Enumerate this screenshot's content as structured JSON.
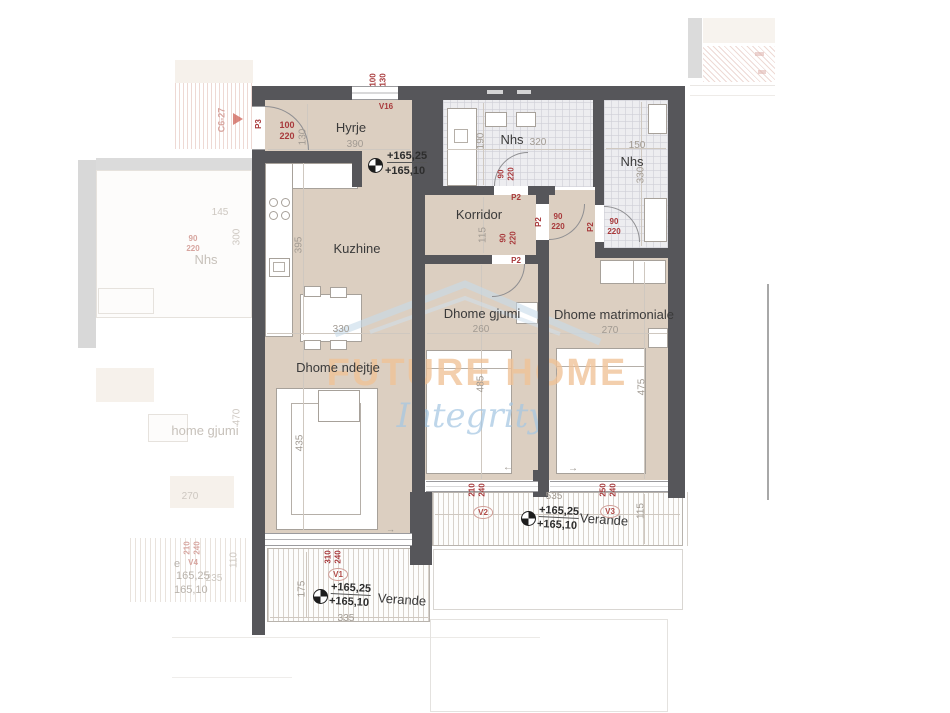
{
  "watermark": {
    "brand": "FUTURE HOME",
    "tagline": "Integrity"
  },
  "rooms": {
    "hyrje": "Hyrje",
    "kuzhine": "Kuzhine",
    "korridor": "Korridor",
    "nhs_top": "Nhs",
    "nhs_right": "Nhs",
    "dhome_gjumi": "Dhome gjumi",
    "dhome_matrimoniale": "Dhome matrimoniale",
    "dhome_ndejtje": "Dhome ndejtje",
    "verande_left": "Verande",
    "verande_right": "Verande"
  },
  "dims": {
    "hyrje_w": "390",
    "hyrje_h": "130",
    "kuzhine_h": "395",
    "table_w": "330",
    "sofa_h": "435",
    "nhs_top_w": "320",
    "nhs_top_h": "190",
    "nhs_right_w": "150",
    "nhs_right_h": "330",
    "korridor_w": "115",
    "gjumi_w": "260",
    "gjumi_h": "485",
    "matrimoniale_w": "270",
    "matrimoniale_h": "475",
    "verande_right_w": "535",
    "verande_right_h": "115",
    "verande_left_w": "335",
    "verande_left_h": "175"
  },
  "openings": {
    "p3": "P3",
    "p3_size": "100\n220",
    "v16": "V16",
    "v16_size": "100\n130",
    "p2": "P2",
    "p2_size": "90\n220",
    "v1": "V1",
    "v1_size": "310\n240",
    "v2": "V2",
    "v2_size": "210\n240",
    "v3": "V3",
    "v3_size": "250\n240"
  },
  "elevation": {
    "upper": "+165,25",
    "lower": "+165,10"
  },
  "icons": {
    "slide_left": "←",
    "slide_right": "→"
  },
  "neighbor": {
    "section": "C6-27",
    "nhs": "Nhs",
    "nhs_w": "145",
    "nhs_h": "300",
    "door_size": "90\n220",
    "gjumi": "home gjumi",
    "gjumi_h": "470",
    "gjumi_w": "270",
    "verande_e": "e",
    "v4": "V4",
    "elev_upper": "165,25",
    "elev_lower": "165,10",
    "verande_w": "235",
    "verande_h": "110",
    "door2_size": "210\n240"
  }
}
